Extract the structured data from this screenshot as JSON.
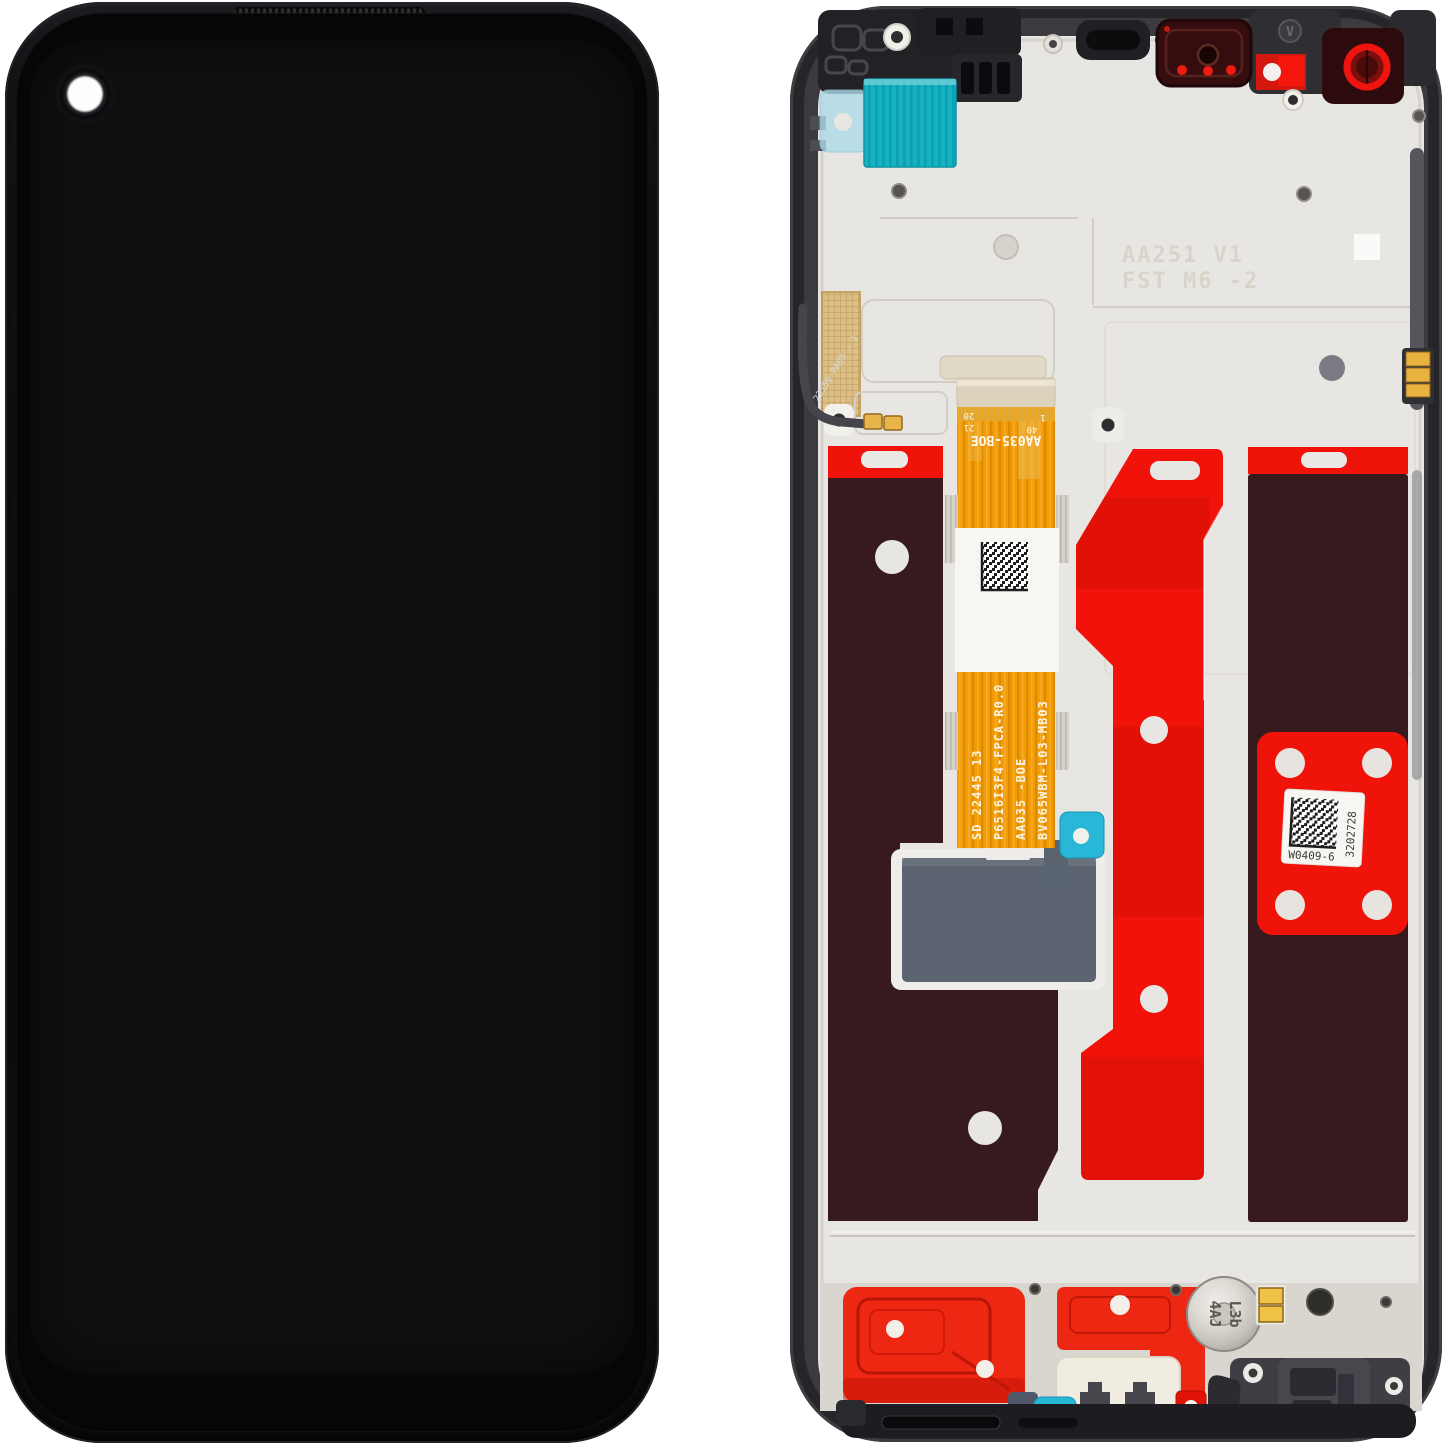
{
  "back_view": {
    "main_flex": {
      "connector_label": "AA035-BOE",
      "pins": {
        "p1": "1",
        "p40": "40",
        "p20": "20",
        "p21": "21"
      },
      "serials": [
        "SD 22445 13",
        "P6516I3F4-FPCA-R0.0",
        "AA035 -BOE",
        "BV065WBM-L03-MB03"
      ]
    },
    "qr_label": {
      "line": "W0409-6",
      "serial_vertical": "3202728"
    },
    "embossed": {
      "line1": "AA251 V1",
      "line2": "FST M6 -2"
    },
    "motor": {
      "line1": "L3b",
      "line2": "4AJ"
    },
    "side_flex_label": "23159 PA05 - 1",
    "frame_marking": "V",
    "colors": {
      "adhesive_red": "#f1130a",
      "adhesive_brown": "#361a1d",
      "flex_orange": "#f49c05",
      "teal": "#16b3c3",
      "plate": "#e8e6e2",
      "frame": "#26262a"
    }
  }
}
